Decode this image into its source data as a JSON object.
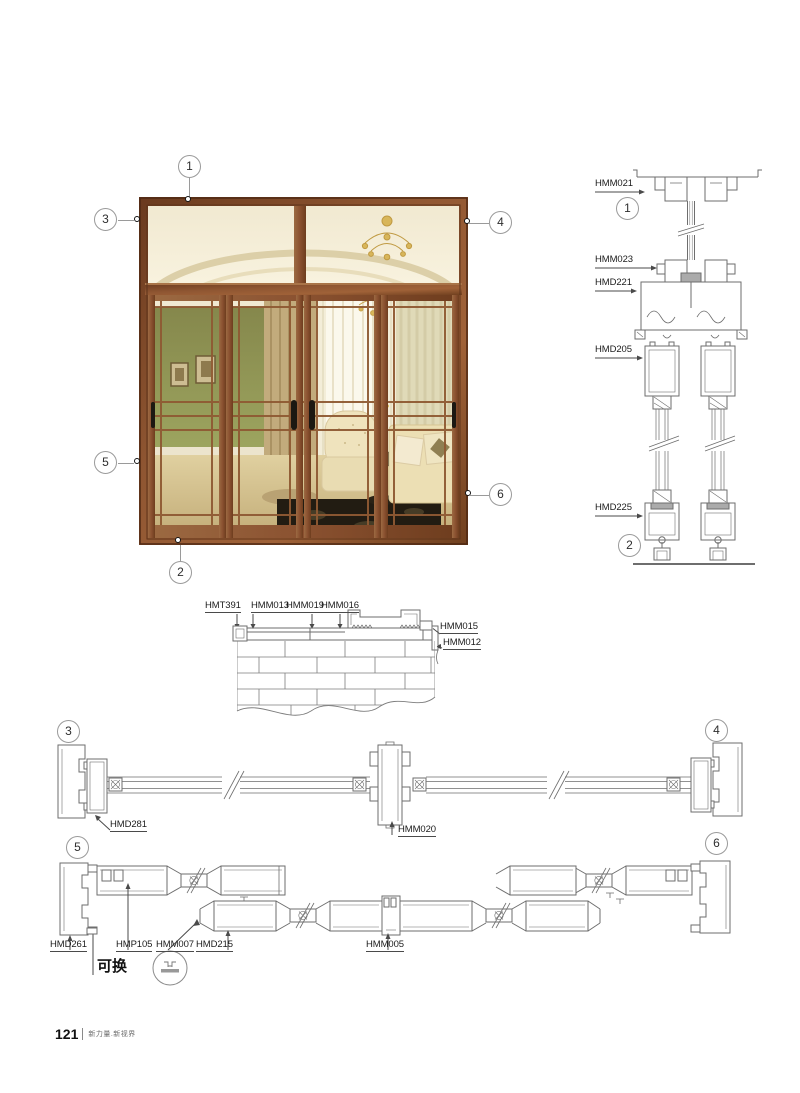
{
  "page": {
    "footer": {
      "page_number": "121",
      "slogan": "新力量.新视界"
    }
  },
  "photo": {
    "alt": "four-panel wood-grain sliding door with glass transom and interior scene",
    "callouts": [
      {
        "n": "1"
      },
      {
        "n": "2"
      },
      {
        "n": "3"
      },
      {
        "n": "4"
      },
      {
        "n": "5"
      },
      {
        "n": "6"
      }
    ]
  },
  "vertical_section": {
    "callout_top": "1",
    "callout_bottom": "2",
    "labels": {
      "l1": "HMM021",
      "l2": "HMM023",
      "l3": "HMD221",
      "l4": "HMD205",
      "l5": "HMD225"
    }
  },
  "sill_detail": {
    "labels": {
      "l1": "HMT391",
      "l2": "HMM013",
      "l3": "HMM019",
      "l4": "HMM016",
      "l5": "HMM015",
      "l6": "HMM012"
    }
  },
  "section_34": {
    "callout_left": "3",
    "callout_right": "4",
    "labels": {
      "l1": "HMD281",
      "l2": "HMM020"
    }
  },
  "section_56": {
    "callout_left": "5",
    "callout_right": "6",
    "labels": {
      "l1": "HMD261",
      "l2": "HMP105",
      "l3": "HMM007",
      "l4": "HMD215",
      "l5": "HMM005"
    },
    "note": "可换"
  },
  "colors": {
    "line": "#6e6e6e",
    "label": "#1c1c1c",
    "callout_border": "#9a9a9a",
    "wood": "#8a5130"
  }
}
